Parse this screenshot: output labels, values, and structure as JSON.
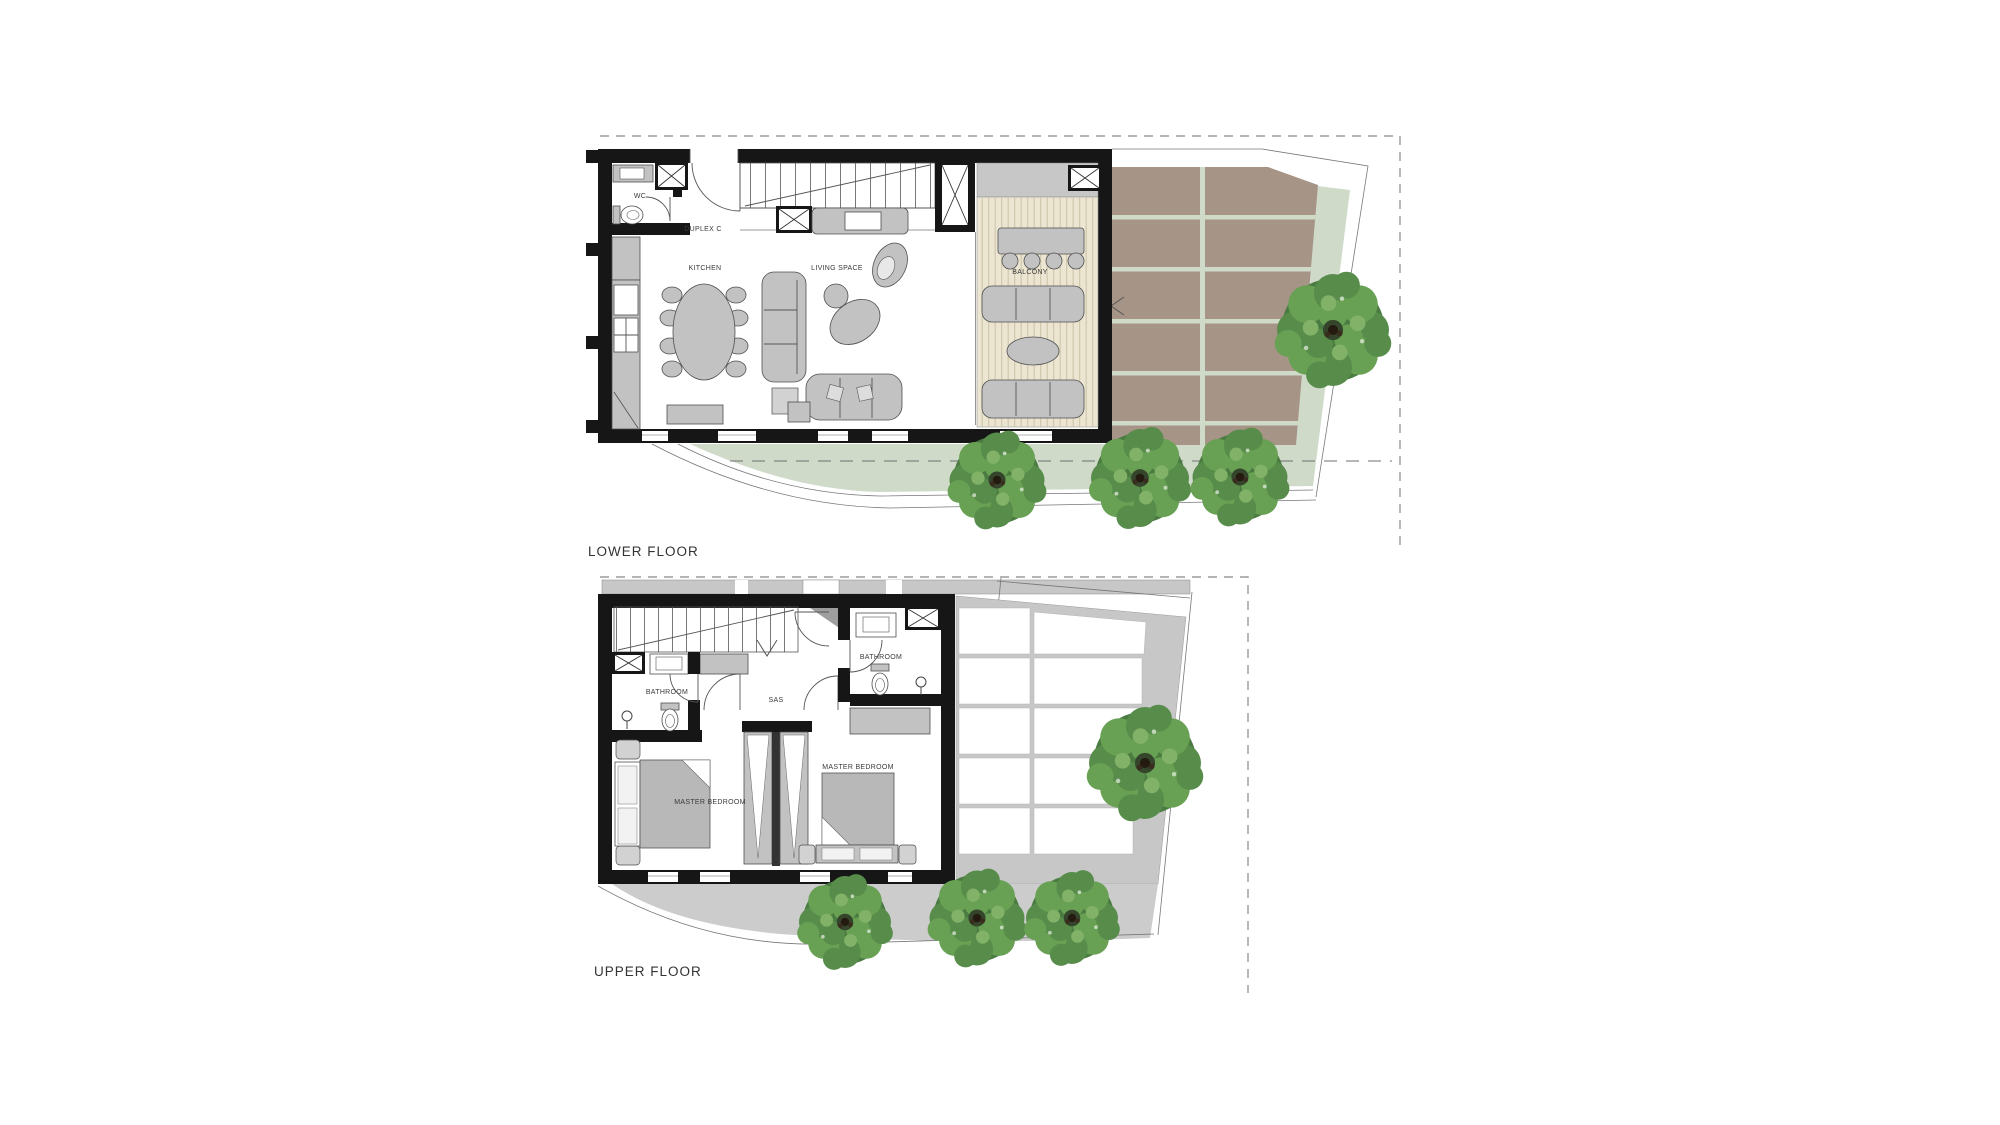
{
  "palette": {
    "wall": "#161616",
    "furniture_gray": "#c2c2c2",
    "furniture_outline": "#4f4f4f",
    "deck": "#ebe5d1",
    "deck_line": "#cdc6ab",
    "pergola_brown": "#a69486",
    "lawn_green": "#cfdac9",
    "path_gray": "#cccccc",
    "concrete_gray": "#c7c7c7",
    "boundary_dash": "#9b9b9b",
    "tree_base": "#4a7b41",
    "tree_mid": "#578c4a",
    "tree_light": "#68a054",
    "tree_highlight": "#82b268",
    "trunk": "#241a10",
    "label_color": "#3a3a3a"
  },
  "lower_floor": {
    "title": "LOWER FLOOR",
    "labels": {
      "wc": "WC",
      "duplex": "DUPLEX C",
      "kitchen": "KITCHEN",
      "living": "LIVING SPACE",
      "balcony": "BALCONY"
    }
  },
  "upper_floor": {
    "title": "UPPER FLOOR",
    "labels": {
      "bathroom_left": "BATHROOM",
      "bathroom_right": "BATHROOM",
      "sas": "SAS",
      "master_left": "MASTER BEDROOM",
      "master_right": "MASTER BEDROOM"
    }
  }
}
